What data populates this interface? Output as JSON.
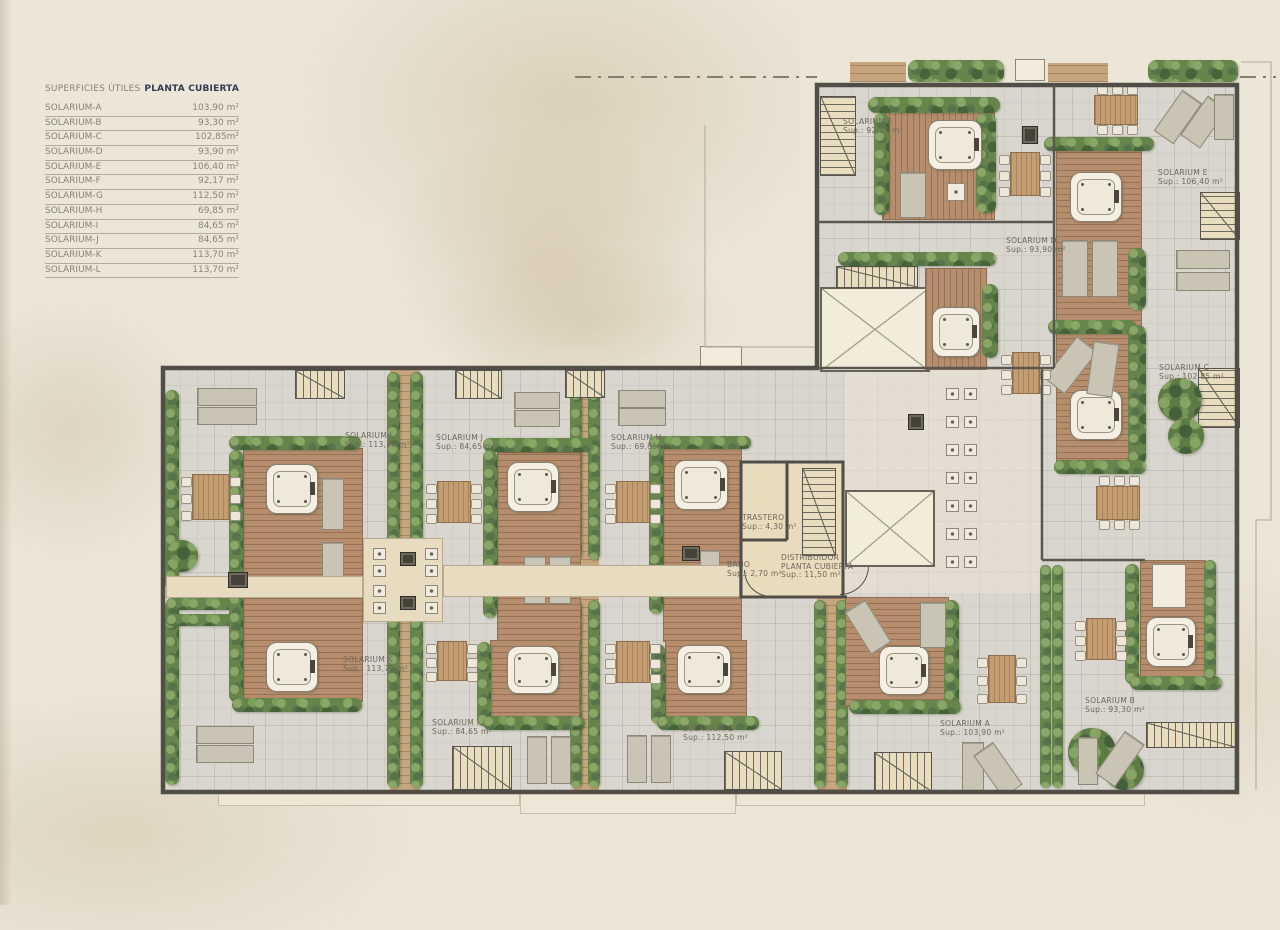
{
  "legend": {
    "title": "SUPERFICIES ÚTILES",
    "subtitle": "PLANTA CUBIERTA",
    "rows": [
      {
        "name": "SOLARIUM-A",
        "value": "103,90 m²"
      },
      {
        "name": "SOLARIUM-B",
        "value": "93,30 m²"
      },
      {
        "name": "SOLARIUM-C",
        "value": "102,85m²"
      },
      {
        "name": "SOLARIUM-D",
        "value": "93,90 m²"
      },
      {
        "name": "SOLARIUM-E",
        "value": "106,40 m²"
      },
      {
        "name": "SOLARIUM-F",
        "value": "92,17 m²"
      },
      {
        "name": "SOLARIUM-G",
        "value": "112,50 m²"
      },
      {
        "name": "SOLARIUM-H",
        "value": "69,85 m²"
      },
      {
        "name": "SOLARIUM-I",
        "value": "84,65 m²"
      },
      {
        "name": "SOLARIUM-J",
        "value": "84,65 m²"
      },
      {
        "name": "SOLARIUM-K",
        "value": "113,70 m²"
      },
      {
        "name": "SOLARIUM-L",
        "value": "113,70 m²"
      }
    ]
  },
  "plan": {
    "labels": [
      {
        "id": "solarium-f",
        "lines": [
          "SOLARIUM F",
          "Sup.: 92,17 m²"
        ],
        "x": 843,
        "y": 118
      },
      {
        "id": "solarium-e",
        "lines": [
          "SOLARIUM E",
          "Sup.: 106,40 m²"
        ],
        "x": 1158,
        "y": 169
      },
      {
        "id": "solarium-d",
        "lines": [
          "SOLARIUM D",
          "Sup.: 93,90 m²"
        ],
        "x": 1006,
        "y": 237
      },
      {
        "id": "solarium-c",
        "lines": [
          "SOLARIUM C",
          "Sup.: 102,85 m²"
        ],
        "x": 1159,
        "y": 364
      },
      {
        "id": "solarium-l",
        "lines": [
          "SOLARIUM L",
          "Sup.: 113,70 m²"
        ],
        "x": 345,
        "y": 432
      },
      {
        "id": "solarium-j",
        "lines": [
          "SOLARIUM J",
          "Sup.: 84,65 m²"
        ],
        "x": 436,
        "y": 434
      },
      {
        "id": "solarium-h",
        "lines": [
          "SOLARIUM H",
          "Sup.: 69,85 m²"
        ],
        "x": 611,
        "y": 434
      },
      {
        "id": "solarium-k",
        "lines": [
          "SOLARIUM K",
          "Sup.: 113,70 m²"
        ],
        "x": 343,
        "y": 656
      },
      {
        "id": "solarium-i",
        "lines": [
          "SOLARIUM I",
          "Sup.: 84,65 m²"
        ],
        "x": 432,
        "y": 719
      },
      {
        "id": "solarium-g",
        "lines": [
          "SOLARIUM G",
          "Sup.: 112,50 m²"
        ],
        "x": 683,
        "y": 725
      },
      {
        "id": "solarium-a",
        "lines": [
          "SOLARIUM A",
          "Sup.: 103,90 m²"
        ],
        "x": 940,
        "y": 720
      },
      {
        "id": "solarium-b",
        "lines": [
          "SOLARIUM B",
          "Sup.: 93,30 m²"
        ],
        "x": 1085,
        "y": 697
      },
      {
        "id": "trastero",
        "lines": [
          "TRASTERO",
          "Sup.: 4,30 m²"
        ],
        "x": 742,
        "y": 514
      },
      {
        "id": "bano",
        "lines": [
          "BAÑO",
          "Sup.: 2,70 m²"
        ],
        "x": 727,
        "y": 561
      },
      {
        "id": "distribuidor",
        "lines": [
          "DISTRIBUIDOR",
          "PLANTA CUBIERTA",
          "Sup.: 11,50 m²"
        ],
        "x": 781,
        "y": 554
      }
    ]
  },
  "colors": {
    "paper": "#ece6d9",
    "accent_navy": "#323a52",
    "wall": "#514e47",
    "wood": "#b68e6e",
    "hedge": "#67844d"
  }
}
